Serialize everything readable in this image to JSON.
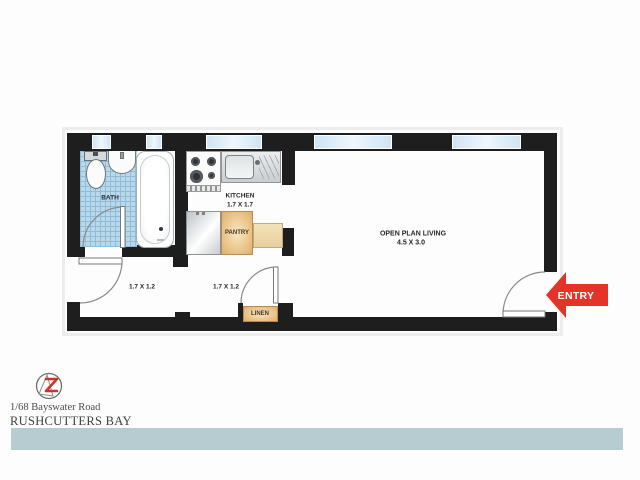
{
  "plan": {
    "labels": {
      "bath": "BATH",
      "kitchen": "KITCHEN",
      "kitchen_dims": "1.7 X 1.7",
      "hall_left_dims": "1.7 X 1.2",
      "hall_right_dims": "1.7 X 1.2",
      "living": "OPEN PLAN LIVING",
      "living_dims": "4.5 X 3.0",
      "pantry": "PANTRY",
      "linen": "LINEN",
      "entry": "ENTRY"
    },
    "fixtures": [
      "toilet",
      "basin",
      "bathtub",
      "stove",
      "kitchen-sink",
      "fridge",
      "pantry-cupboard",
      "bench-cupboard",
      "linen-cupboard"
    ],
    "windows_count": 5,
    "doors_count": 4
  },
  "footer": {
    "address_line1": "1/68 Bayswater Road",
    "suburb": "RUSHCUTTERS BAY"
  },
  "colors": {
    "wall": "#1e1e1e",
    "window_glass": "#cfe4f4",
    "bath_tile": "#b9d8ea",
    "cabinet_tan": "#e8c28a",
    "entry_arrow_red": "#e5332a",
    "footer_band": "#b6ccd1",
    "logo_red": "#c9342c"
  }
}
